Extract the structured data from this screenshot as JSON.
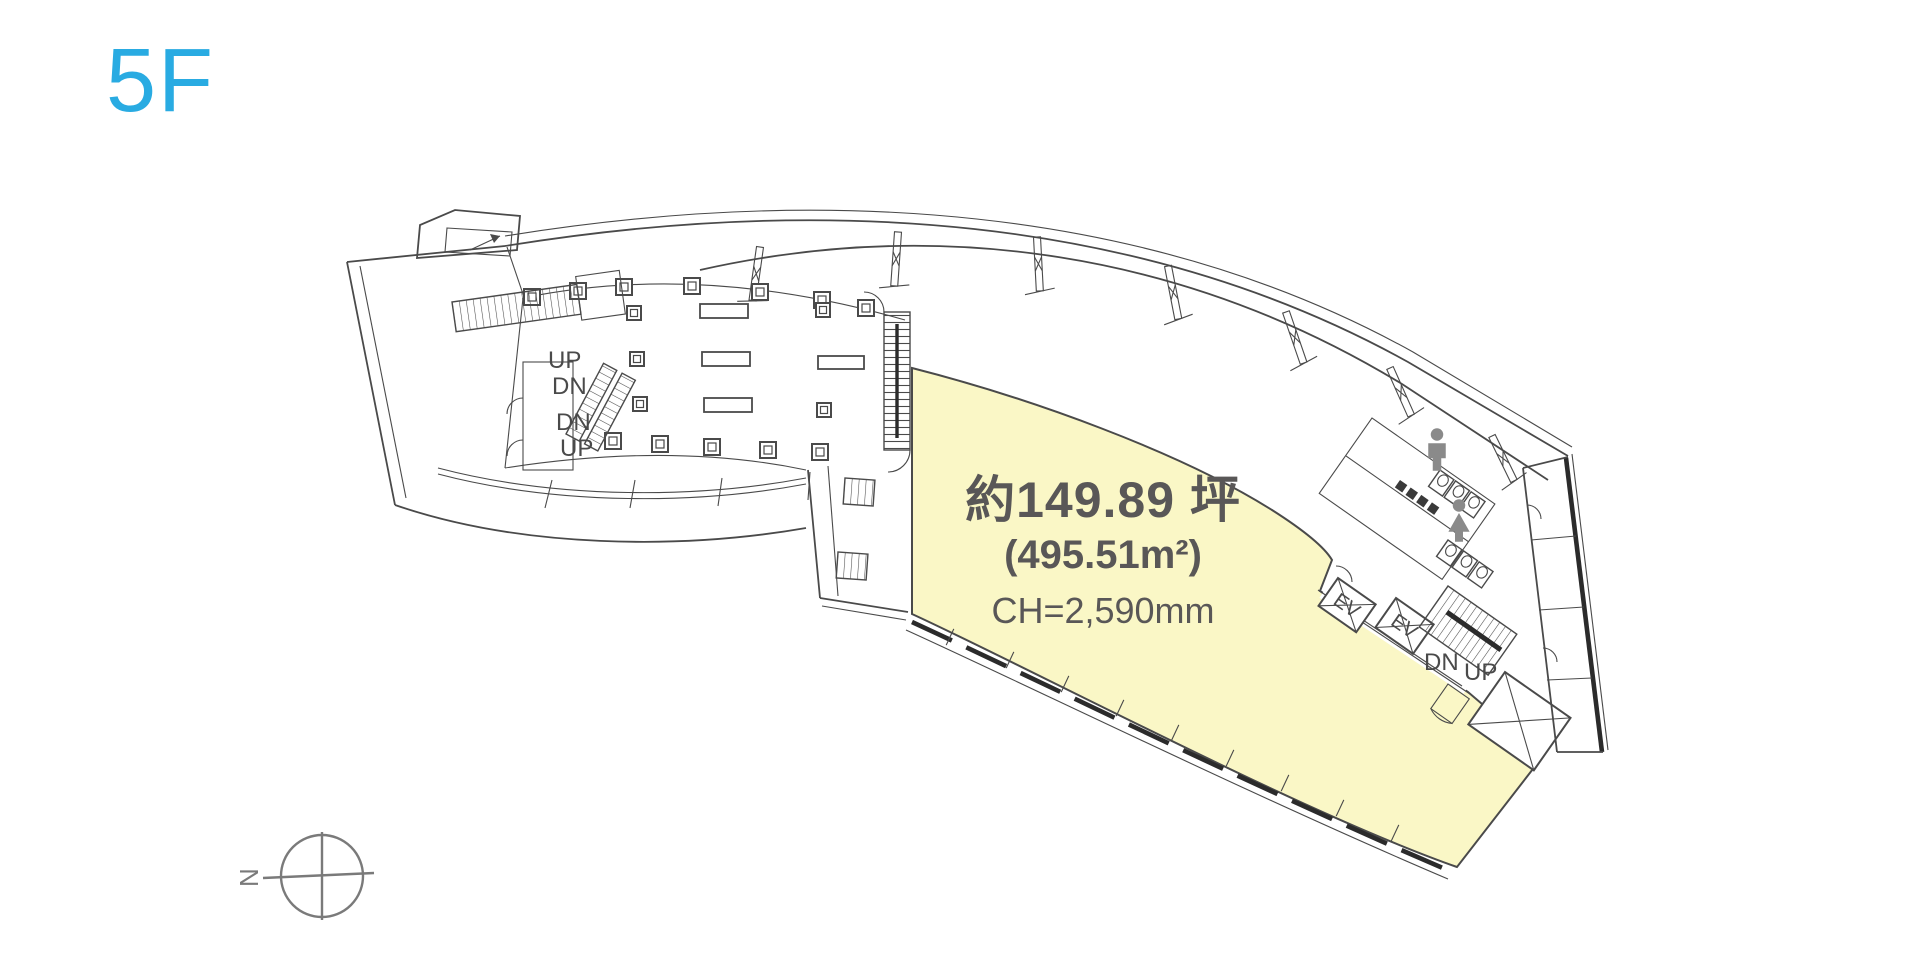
{
  "page": {
    "floor_label": "5F"
  },
  "colors": {
    "accent": "#29abe2",
    "area": "#faf7c6",
    "line": "#4a4a4a",
    "dark": "#2b2b2b",
    "labeltext": "#595757",
    "icon": "#8a8a8a",
    "compass": "#7a7a7a"
  },
  "area_label": {
    "tsubo": "約149.89 坪",
    "sqm": "(495.51m²)",
    "ceiling_height": "CH=2,590mm"
  },
  "plan_labels": {
    "escalator": [
      "UP",
      "DN",
      "DN",
      "UP"
    ],
    "stair_core": {
      "dn": "DN",
      "up": "UP"
    },
    "elevators": [
      "EV",
      "EV"
    ]
  },
  "compass": {
    "north_label": "N"
  }
}
